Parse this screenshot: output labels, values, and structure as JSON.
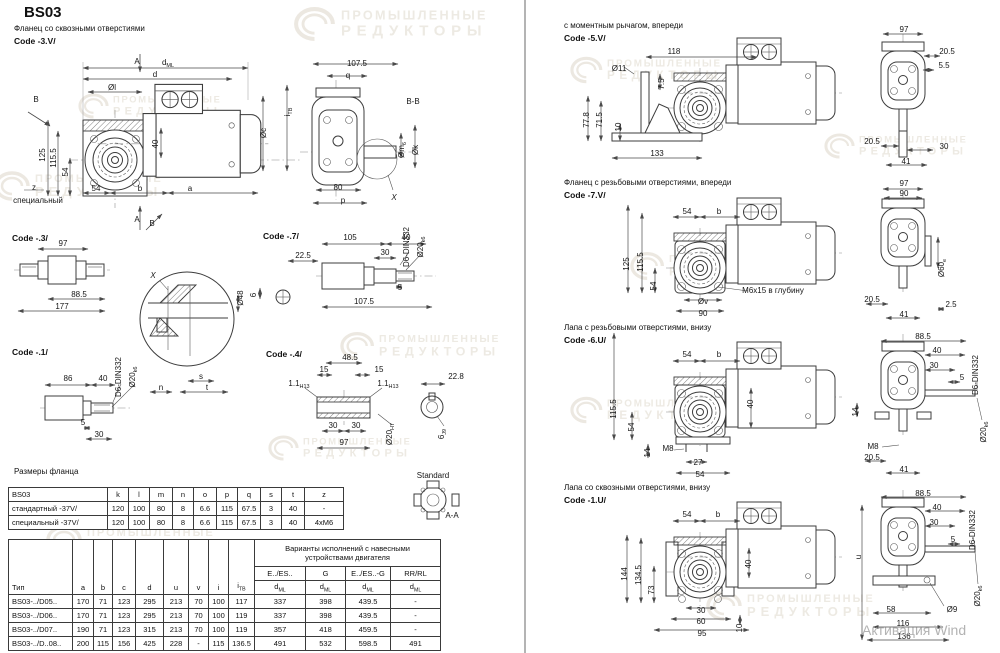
{
  "page": {
    "title": "BS03",
    "activation_watermark": "Активация Wind"
  },
  "watermark": {
    "line1": "ПРОМЫШЛЕННЫЕ",
    "line2": "РЕДУКТОРЫ",
    "color": "#ece8e1",
    "positions": [
      {
        "x": 300,
        "y": 6,
        "s": 1.15
      },
      {
        "x": -12,
        "y": 168,
        "s": 1
      },
      {
        "x": 60,
        "y": 88,
        "s": 0.85
      },
      {
        "x": 330,
        "y": 328,
        "s": 0.95
      },
      {
        "x": 40,
        "y": 522,
        "s": 1
      },
      {
        "x": 556,
        "y": 52,
        "s": 0.9
      },
      {
        "x": 620,
        "y": 248,
        "s": 0.95
      },
      {
        "x": 806,
        "y": 128,
        "s": 0.85
      },
      {
        "x": 556,
        "y": 392,
        "s": 0.9
      },
      {
        "x": 700,
        "y": 588,
        "s": 1
      },
      {
        "x": 250,
        "y": 430,
        "s": 0.85
      }
    ]
  },
  "captions": {
    "flange_through": "Фланец со сквозными отверстиями",
    "code_3v": "Code -3.V/",
    "code_3": "Code -.3/",
    "code_1": "Code -.1/",
    "code_7": "Code -.7/",
    "code_4": "Code -.4/",
    "flange_dims_title": "Размеры фланца",
    "torque_arm": "с моментным рычагом, впереди",
    "code_5v": "Code -5.V/",
    "flange_tapped": "Фланец с резьбовыми отверстиями, впереди",
    "code_7v": "Code -7.V/",
    "foot_tapped": "Лапа с резьбовыми отверстиями, внизу",
    "code_6u": "Code -6.U/",
    "foot_through": "Лапа со сквозными отверстиями, внизу",
    "code_1u": "Code -1.U/"
  },
  "labels": [
    {
      "t": "A",
      "x": 137,
      "y": 64,
      "fs": 10
    },
    {
      "t": "d",
      "sub": "ML",
      "x": 168,
      "y": 65
    },
    {
      "t": "d",
      "x": 155,
      "y": 77
    },
    {
      "t": "Øl",
      "x": 112,
      "y": 90
    },
    {
      "t": "40",
      "x": 158,
      "y": 144,
      "r": -90
    },
    {
      "t": "i",
      "sub": "ТВ",
      "x": 290,
      "y": 112,
      "r": -90
    },
    {
      "t": "Øc",
      "x": 266,
      "y": 133,
      "r": -90
    },
    {
      "t": "125",
      "x": 45,
      "y": 155,
      "r": -90
    },
    {
      "t": "115.5",
      "x": 56,
      "y": 158,
      "r": -90
    },
    {
      "t": "54",
      "x": 68,
      "y": 172,
      "r": -90
    },
    {
      "t": "z",
      "x": 34,
      "y": 190
    },
    {
      "t": "специальный",
      "x": 38,
      "y": 203,
      "fs": 7.5
    },
    {
      "t": "54",
      "x": 96,
      "y": 191
    },
    {
      "t": "b",
      "x": 140,
      "y": 191
    },
    {
      "t": "a",
      "x": 190,
      "y": 191
    },
    {
      "t": "A",
      "x": 137,
      "y": 222,
      "fs": 10
    },
    {
      "t": "B",
      "x": 36,
      "y": 102,
      "fs": 10
    },
    {
      "t": "B",
      "x": 152,
      "y": 226,
      "fs": 10
    },
    {
      "t": "107.5",
      "x": 357,
      "y": 66
    },
    {
      "t": "q",
      "x": 348,
      "y": 78
    },
    {
      "t": "B-B",
      "x": 413,
      "y": 104,
      "fs": 10
    },
    {
      "t": "Øm",
      "sub": "6",
      "x": 404,
      "y": 150,
      "r": -90
    },
    {
      "t": "Øk",
      "x": 418,
      "y": 150,
      "r": -90
    },
    {
      "t": "80",
      "x": 338,
      "y": 190
    },
    {
      "t": "p",
      "x": 343,
      "y": 203
    },
    {
      "t": "X",
      "x": 394,
      "y": 200,
      "fs": 11,
      "i": true
    },
    {
      "t": "97",
      "x": 63,
      "y": 246
    },
    {
      "t": "88.5",
      "x": 79,
      "y": 297
    },
    {
      "t": "177",
      "x": 62,
      "y": 309
    },
    {
      "t": "X",
      "x": 153,
      "y": 278,
      "fs": 11,
      "i": true
    },
    {
      "t": "Ø48",
      "x": 243,
      "y": 298,
      "r": -90
    },
    {
      "t": "6",
      "x": 256,
      "y": 295,
      "r": -90
    },
    {
      "t": "s",
      "x": 201,
      "y": 379
    },
    {
      "t": "n",
      "x": 161,
      "y": 390
    },
    {
      "t": "t",
      "x": 207,
      "y": 390
    },
    {
      "t": "22.5",
      "x": 303,
      "y": 258
    },
    {
      "t": "105",
      "x": 350,
      "y": 240
    },
    {
      "t": "40",
      "x": 406,
      "y": 240
    },
    {
      "t": "30",
      "x": 385,
      "y": 255
    },
    {
      "t": "D6-DIN332",
      "x": 409,
      "y": 247,
      "r": -90,
      "fs": 6.5
    },
    {
      "t": "Ø20",
      "sub": "k6",
      "x": 423,
      "y": 247,
      "r": -90,
      "fs": 7
    },
    {
      "t": "5",
      "x": 400,
      "y": 290
    },
    {
      "t": "107.5",
      "x": 364,
      "y": 304
    },
    {
      "t": "86",
      "x": 68,
      "y": 381
    },
    {
      "t": "40",
      "x": 103,
      "y": 381
    },
    {
      "t": "D6-DIN332",
      "x": 121,
      "y": 377,
      "r": -90,
      "fs": 6.5
    },
    {
      "t": "Ø20",
      "sub": "k6",
      "x": 135,
      "y": 377,
      "r": -90,
      "fs": 7
    },
    {
      "t": "5",
      "x": 83,
      "y": 425
    },
    {
      "t": "30",
      "x": 99,
      "y": 437
    },
    {
      "t": "48.5",
      "x": 350,
      "y": 360
    },
    {
      "t": "15",
      "x": 324,
      "y": 372
    },
    {
      "t": "15",
      "x": 379,
      "y": 372
    },
    {
      "t": "1.1",
      "sub": "H13",
      "x": 299,
      "y": 386,
      "fs": 7
    },
    {
      "t": "1.1",
      "sub": "H13",
      "x": 388,
      "y": 386,
      "fs": 7
    },
    {
      "t": "30",
      "x": 333,
      "y": 428
    },
    {
      "t": "30",
      "x": 356,
      "y": 428
    },
    {
      "t": "97",
      "x": 344,
      "y": 445
    },
    {
      "t": "Ø20",
      "sub": "H7",
      "x": 392,
      "y": 434,
      "r": -90,
      "fs": 7
    },
    {
      "t": "22.8",
      "x": 456,
      "y": 379
    },
    {
      "t": "6",
      "sub": "J9",
      "x": 444,
      "y": 434,
      "r": -90,
      "fs": 7
    },
    {
      "t": "Standard",
      "x": 433,
      "y": 478,
      "fs": 6
    },
    {
      "t": "A-A",
      "x": 452,
      "y": 518,
      "fs": 9
    },
    {
      "t": "118",
      "x": 674,
      "y": 54
    },
    {
      "t": "Ø11",
      "x": 619,
      "y": 71
    },
    {
      "t": "7.5",
      "x": 664,
      "y": 84,
      "r": -90
    },
    {
      "t": "77.8",
      "x": 589,
      "y": 120,
      "r": -90
    },
    {
      "t": "71.5",
      "x": 602,
      "y": 120,
      "r": -90
    },
    {
      "t": "10",
      "x": 621,
      "y": 127,
      "r": -90
    },
    {
      "t": "133",
      "x": 657,
      "y": 156
    },
    {
      "t": "97",
      "x": 904,
      "y": 32
    },
    {
      "t": "20.5",
      "x": 947,
      "y": 54
    },
    {
      "t": "5.5",
      "x": 944,
      "y": 68
    },
    {
      "t": "20.5",
      "x": 872,
      "y": 144
    },
    {
      "t": "30",
      "x": 944,
      "y": 149
    },
    {
      "t": "41",
      "x": 906,
      "y": 164
    },
    {
      "t": "54",
      "x": 687,
      "y": 214
    },
    {
      "t": "b",
      "x": 719,
      "y": 214
    },
    {
      "t": "125",
      "x": 629,
      "y": 264,
      "r": -90
    },
    {
      "t": "115.5",
      "x": 643,
      "y": 262,
      "r": -90
    },
    {
      "t": "54",
      "x": 656,
      "y": 286,
      "r": -90
    },
    {
      "t": "Øv",
      "x": 703,
      "y": 304
    },
    {
      "t": "90",
      "x": 703,
      "y": 316
    },
    {
      "t": "M6x15 в глубину",
      "x": 773,
      "y": 293,
      "fs": 7.5
    },
    {
      "t": "97",
      "x": 904,
      "y": 186
    },
    {
      "t": "90",
      "x": 904,
      "y": 196
    },
    {
      "t": "Ø60",
      "sub": "e",
      "x": 944,
      "y": 268,
      "r": -90,
      "fs": 7
    },
    {
      "t": "20.5",
      "x": 872,
      "y": 302
    },
    {
      "t": "2.5",
      "x": 951,
      "y": 307
    },
    {
      "t": "41",
      "x": 904,
      "y": 317
    },
    {
      "t": "54",
      "x": 687,
      "y": 357
    },
    {
      "t": "b",
      "x": 719,
      "y": 357
    },
    {
      "t": "115.5",
      "x": 616,
      "y": 409,
      "r": -90
    },
    {
      "t": "54",
      "x": 634,
      "y": 427,
      "r": -90
    },
    {
      "t": "40",
      "x": 753,
      "y": 404,
      "r": -90
    },
    {
      "t": "14",
      "x": 650,
      "y": 453,
      "r": -90
    },
    {
      "t": "M8",
      "x": 668,
      "y": 451
    },
    {
      "t": "27",
      "x": 698,
      "y": 465
    },
    {
      "t": "54",
      "x": 700,
      "y": 477
    },
    {
      "t": "88.5",
      "x": 923,
      "y": 339
    },
    {
      "t": "40",
      "x": 937,
      "y": 353
    },
    {
      "t": "30",
      "x": 934,
      "y": 368
    },
    {
      "t": "5",
      "x": 962,
      "y": 380
    },
    {
      "t": "D6-DIN332",
      "x": 978,
      "y": 375,
      "r": -90,
      "fs": 6.5
    },
    {
      "t": "14",
      "x": 858,
      "y": 412,
      "r": -90
    },
    {
      "t": "M8",
      "x": 873,
      "y": 449
    },
    {
      "t": "20.5",
      "x": 872,
      "y": 460
    },
    {
      "t": "41",
      "x": 904,
      "y": 472
    },
    {
      "t": "Ø20",
      "sub": "k6",
      "x": 986,
      "y": 432,
      "r": -90,
      "fs": 7
    },
    {
      "t": "54",
      "x": 687,
      "y": 517
    },
    {
      "t": "b",
      "x": 718,
      "y": 517
    },
    {
      "t": "144",
      "x": 627,
      "y": 574,
      "r": -90
    },
    {
      "t": "134.5",
      "x": 641,
      "y": 575,
      "r": -90
    },
    {
      "t": "73",
      "x": 654,
      "y": 590,
      "r": -90
    },
    {
      "t": "40",
      "x": 751,
      "y": 564,
      "r": -90
    },
    {
      "t": "30",
      "x": 701,
      "y": 613
    },
    {
      "t": "60",
      "x": 701,
      "y": 624
    },
    {
      "t": "95",
      "x": 702,
      "y": 636
    },
    {
      "t": "10",
      "x": 742,
      "y": 628,
      "r": -90
    },
    {
      "t": "u",
      "x": 861,
      "y": 557,
      "r": -90
    },
    {
      "t": "88.5",
      "x": 923,
      "y": 496
    },
    {
      "t": "40",
      "x": 937,
      "y": 510
    },
    {
      "t": "30",
      "x": 934,
      "y": 525
    },
    {
      "t": "5",
      "x": 953,
      "y": 542
    },
    {
      "t": "D6-DIN332",
      "x": 975,
      "y": 530,
      "r": -90,
      "fs": 6.5
    },
    {
      "t": "Ø20",
      "sub": "k6",
      "x": 980,
      "y": 596,
      "r": -90,
      "fs": 7
    },
    {
      "t": "58",
      "x": 891,
      "y": 612
    },
    {
      "t": "Ø9",
      "x": 952,
      "y": 612
    },
    {
      "t": "116",
      "x": 903,
      "y": 626
    },
    {
      "t": "136",
      "x": 904,
      "y": 639
    }
  ],
  "flange_table": {
    "headers": [
      "BS03",
      "k",
      "l",
      "m",
      "n",
      "o",
      "p",
      "q",
      "s",
      "t",
      "z"
    ],
    "rows": [
      [
        "стандартный -37V/",
        "120",
        "100",
        "80",
        "8",
        "6.6",
        "115",
        "67.5",
        "3",
        "40",
        "-"
      ],
      [
        "специальный -37V/",
        "120",
        "100",
        "80",
        "8",
        "6.6",
        "115",
        "67.5",
        "3",
        "40",
        "4xM6"
      ]
    ]
  },
  "main_table": {
    "type_label": "Тип",
    "col_labels": [
      "a",
      "b",
      "c",
      "d",
      "u",
      "v",
      "i"
    ],
    "itb": {
      "main": "i",
      "sub": "ТВ"
    },
    "group_line1": "Варианты исполнений с навесными",
    "group_line2": "устройствами двигателя",
    "variant_cols": [
      "E../ES..",
      "G",
      "E../ES..-G",
      "RR/RL"
    ],
    "dml": {
      "main": "d",
      "sub": "ML"
    },
    "rows": [
      [
        "BS03-../D05..",
        "170",
        "71",
        "123",
        "295",
        "213",
        "70",
        "100",
        "117",
        "337",
        "398",
        "439.5",
        "-"
      ],
      [
        "BS03-../D06..",
        "170",
        "71",
        "123",
        "295",
        "213",
        "70",
        "100",
        "119",
        "337",
        "398",
        "439.5",
        "-"
      ],
      [
        "BS03-../D07..",
        "190",
        "71",
        "123",
        "315",
        "213",
        "70",
        "100",
        "119",
        "357",
        "418",
        "459.5",
        "-"
      ],
      [
        "BS03-../D..08..",
        "200",
        "115",
        "156",
        "425",
        "228",
        "-",
        "115",
        "136.5",
        "491",
        "532",
        "598.5",
        "491"
      ]
    ]
  }
}
